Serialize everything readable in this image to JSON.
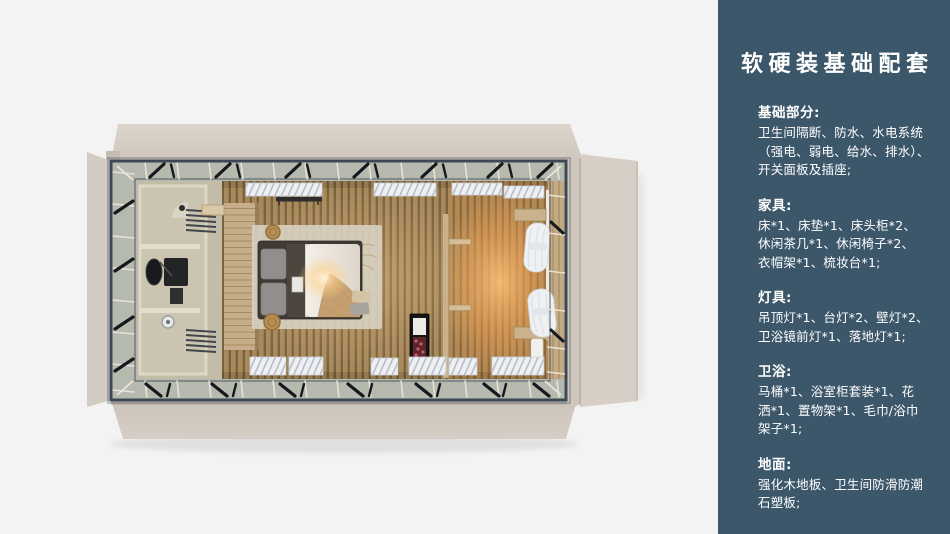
{
  "canvas": {
    "width": 950,
    "height": 534,
    "background": "#f3f3f4"
  },
  "floorplan": {
    "kind": "top-down-room-render",
    "elements": [
      "steel-frame",
      "side-flaps",
      "bathroom",
      "vanity-sink",
      "shower",
      "towel-racks",
      "headboard-wall",
      "double-bed",
      "pillows",
      "knit-throw",
      "area-rug",
      "wall-shelf",
      "storage-baskets",
      "partition-shelves",
      "minibar-cabinet",
      "curtains",
      "wall-benches",
      "ceiling-panel-stacks",
      "wood-slat-floor"
    ],
    "colors": {
      "flap": "#d7d0c7",
      "frame": "#3d4855",
      "band": "#b6b9ae",
      "floor": "#a8895c",
      "floor_stripe": "#7a623e",
      "glow": "#ffb25e",
      "bathroom": "#cbc4b0",
      "wood_wall": "#c7ae8a",
      "duvet": "#f0ebe3",
      "throw": "#c59f70",
      "curtain": "#eef0f2",
      "panel_slats": "#eef0f3"
    }
  },
  "panel": {
    "background": "#3C566A",
    "text_color": "#ffffff",
    "title": "软硬装基础配套",
    "sections": [
      {
        "heading": "基础部分:",
        "lines": [
          "卫生间隔断、防水、水电系统",
          "（强电、弱电、给水、排水）、",
          "开关面板及插座;"
        ]
      },
      {
        "heading": "家具:",
        "lines": [
          "床*1、床垫*1、床头柜*2、",
          "休闲茶几*1、休闲椅子*2、",
          "衣帽架*1、梳妆台*1;"
        ]
      },
      {
        "heading": "灯具:",
        "lines": [
          "吊顶灯*1、台灯*2、壁灯*2、",
          "卫浴镜前灯*1、落地灯*1;"
        ]
      },
      {
        "heading": "卫浴:",
        "lines": [
          "马桶*1、浴室柜套装*1、花",
          "洒*1、置物架*1、毛巾/浴巾",
          "架子*1;"
        ]
      },
      {
        "heading": "地面:",
        "lines": [
          "强化木地板、卫生间防滑防潮",
          "石塑板;"
        ]
      }
    ]
  }
}
